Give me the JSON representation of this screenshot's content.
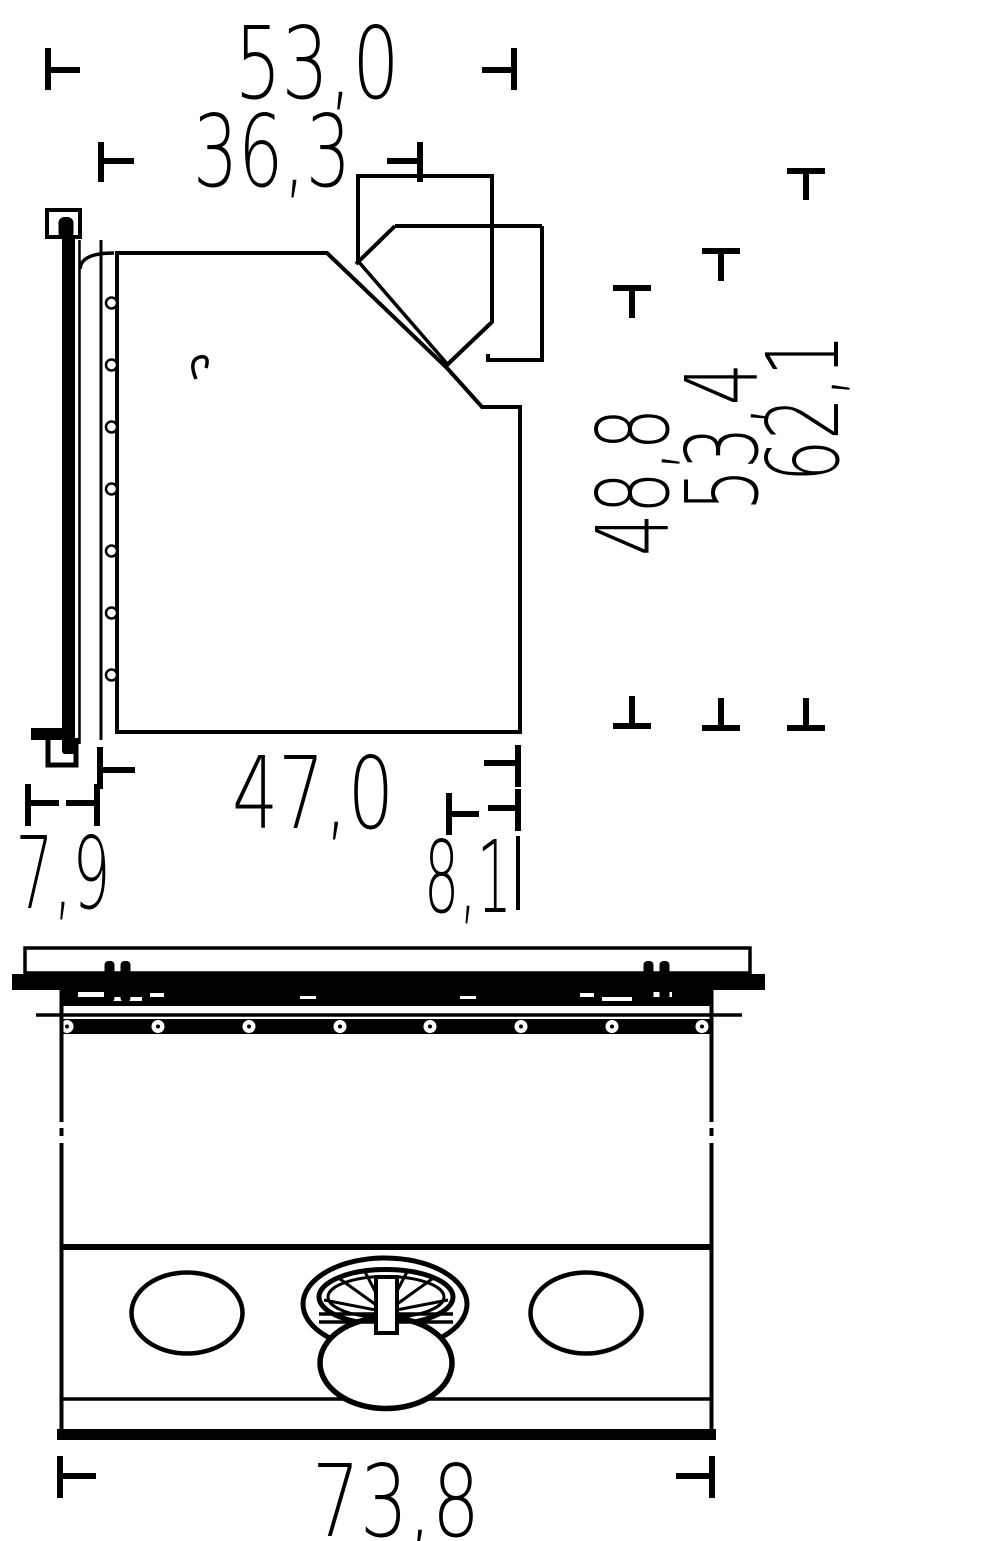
{
  "page": {
    "background": "#ffffff",
    "line_color": "#000000",
    "decimal_separator": ","
  },
  "dimensions": {
    "top_overall_depth": "53,0",
    "top_body_depth": "36,3",
    "height_front": "48,8",
    "height_mid": "53,4",
    "height_total": "62,1",
    "body_depth": "47,0",
    "door_depth": "7,9",
    "rear_offset": "8,1",
    "overall_width": "73,8"
  }
}
